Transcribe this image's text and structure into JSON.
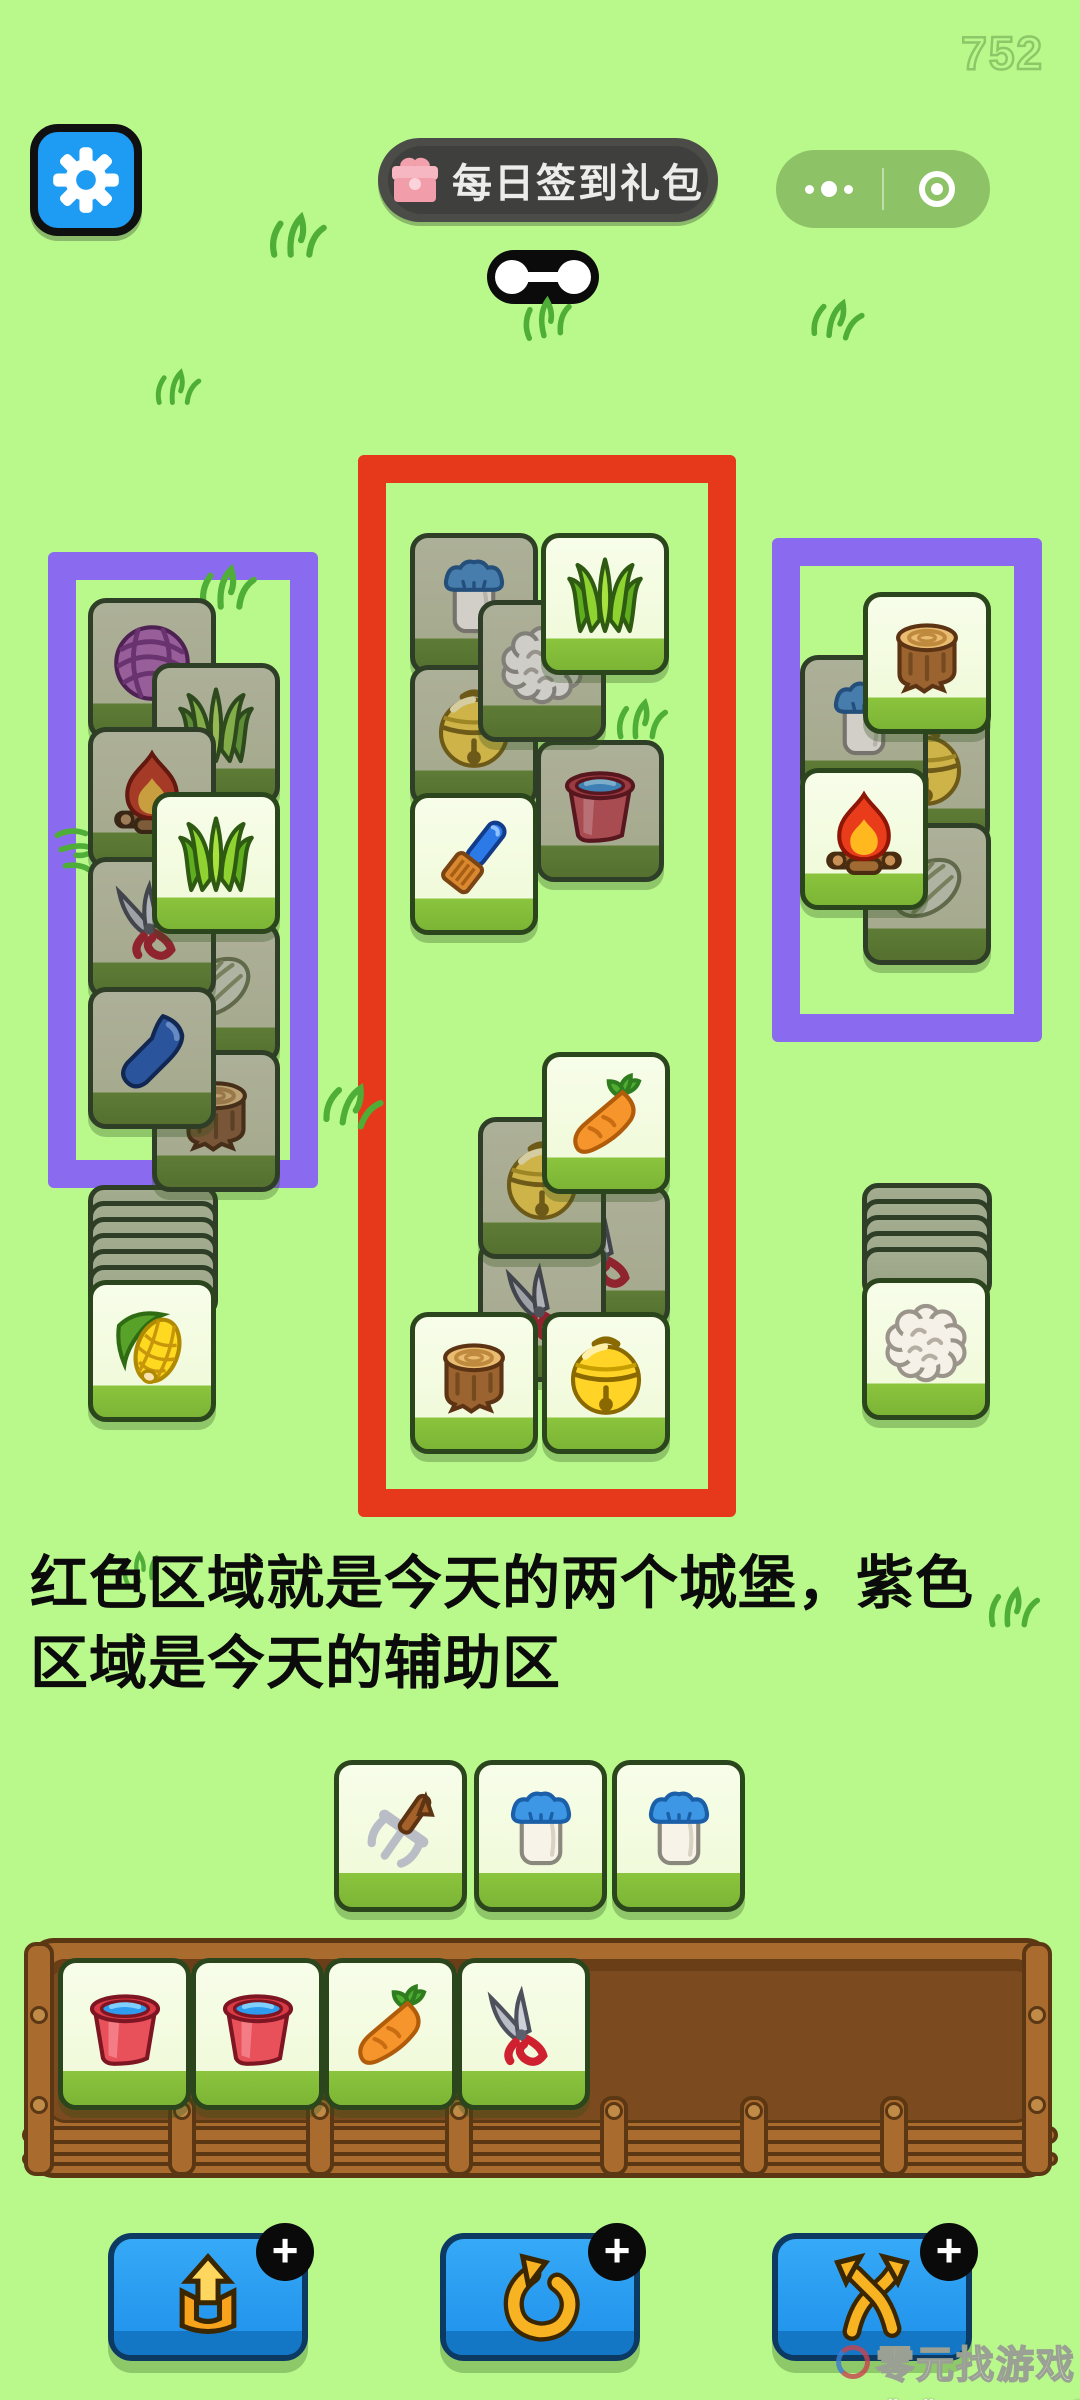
{
  "hud": {
    "counter": "752"
  },
  "gift_button": {
    "label": "每日签到礼包"
  },
  "capsule": {
    "icons": [
      "more-dots-icon",
      "target-circle-icon"
    ]
  },
  "caption": {
    "line1": "红色区域就是今天的两个城堡，紫色",
    "line2": "区域是今天的辅助区"
  },
  "colors": {
    "background": "#b9f98c",
    "red_zone": "#e6391c",
    "purple_zone": "#8a6bef",
    "tile_face_bright": "#f1fadb",
    "tile_face_dim": "#a6aa8e",
    "tray_wood": "#7b4a1e",
    "button_blue": "#1e90ea",
    "settings_blue": "#1e9bf2"
  },
  "board": {
    "groups": [
      {
        "name": "left-aux-purple",
        "tiles": [
          {
            "icon": "yarn",
            "state": "dim",
            "x": 88,
            "y": 598,
            "z": 1
          },
          {
            "icon": "grass",
            "state": "dim",
            "x": 152,
            "y": 663,
            "z": 2
          },
          {
            "icon": "fire",
            "state": "dim",
            "x": 88,
            "y": 727,
            "z": 3
          },
          {
            "icon": "lettuce",
            "state": "dim",
            "x": 152,
            "y": 922,
            "z": 4
          },
          {
            "icon": "shears",
            "state": "dim",
            "x": 88,
            "y": 857,
            "z": 5
          },
          {
            "icon": "stump",
            "state": "dim",
            "x": 152,
            "y": 1050,
            "z": 5
          },
          {
            "icon": "shovel",
            "state": "dim",
            "x": 88,
            "y": 987,
            "z": 6
          },
          {
            "icon": "grass",
            "state": "bright",
            "x": 152,
            "y": 792,
            "z": 7
          }
        ]
      },
      {
        "name": "castle-top-red",
        "tiles": [
          {
            "icon": "milk",
            "state": "dim",
            "x": 410,
            "y": 533,
            "z": 1
          },
          {
            "icon": "bell",
            "state": "dim",
            "x": 410,
            "y": 665,
            "z": 2
          },
          {
            "icon": "bucket",
            "state": "dim",
            "x": 536,
            "y": 740,
            "z": 2
          },
          {
            "icon": "wool",
            "state": "dim",
            "x": 478,
            "y": 600,
            "z": 3
          },
          {
            "icon": "brush",
            "state": "bright",
            "x": 410,
            "y": 793,
            "z": 4
          },
          {
            "icon": "grass",
            "state": "bright",
            "x": 541,
            "y": 533,
            "z": 5
          }
        ]
      },
      {
        "name": "castle-bottom-red",
        "tiles": [
          {
            "icon": "shears",
            "state": "dim",
            "x": 542,
            "y": 1185,
            "z": 1
          },
          {
            "icon": "shears",
            "state": "dim",
            "x": 478,
            "y": 1240,
            "z": 2
          },
          {
            "icon": "bell",
            "state": "dim",
            "x": 478,
            "y": 1117,
            "z": 3
          },
          {
            "icon": "stump",
            "state": "bright",
            "x": 410,
            "y": 1312,
            "z": 4
          },
          {
            "icon": "bell",
            "state": "bright",
            "x": 542,
            "y": 1312,
            "z": 4
          },
          {
            "icon": "carrot",
            "state": "bright",
            "x": 542,
            "y": 1052,
            "z": 5
          }
        ]
      },
      {
        "name": "right-aux-purple",
        "tiles": [
          {
            "icon": "bell",
            "state": "dim",
            "x": 862,
            "y": 703,
            "z": 1
          },
          {
            "icon": "milk",
            "state": "dim",
            "x": 800,
            "y": 655,
            "z": 2
          },
          {
            "icon": "lettuce",
            "state": "dim",
            "x": 863,
            "y": 823,
            "z": 2
          },
          {
            "icon": "fire",
            "state": "bright",
            "x": 800,
            "y": 768,
            "z": 3
          },
          {
            "icon": "stump",
            "state": "bright",
            "x": 863,
            "y": 592,
            "z": 4
          }
        ]
      }
    ]
  },
  "decks": {
    "left": {
      "backs": 6,
      "x": 88,
      "y": 1185,
      "card_y": 1280,
      "top_icon": "corn"
    },
    "right": {
      "backs": 5,
      "x": 862,
      "y": 1183,
      "card_y": 1278,
      "top_icon": "wool"
    }
  },
  "hand": {
    "y": 1760,
    "cards": [
      {
        "icon": "pitchfork",
        "x": 334
      },
      {
        "icon": "milk",
        "x": 474
      },
      {
        "icon": "milk",
        "x": 612
      }
    ]
  },
  "tray": {
    "capacity": 7,
    "slots": [
      "bucket",
      "bucket",
      "carrot",
      "shears"
    ]
  },
  "actions": {
    "badge": "+",
    "buttons": [
      {
        "name": "eject-tool-button",
        "icon": "eject"
      },
      {
        "name": "undo-tool-button",
        "icon": "undo"
      },
      {
        "name": "shuffle-tool-button",
        "icon": "shuffle"
      }
    ]
  },
  "decorations": {
    "doodles": [
      {
        "x": 266,
        "y": 208,
        "r": 0,
        "s": 1
      },
      {
        "x": 515,
        "y": 290,
        "r": -10,
        "s": 0.9
      },
      {
        "x": 806,
        "y": 292,
        "r": 8,
        "s": 0.9
      },
      {
        "x": 146,
        "y": 360,
        "r": 0,
        "s": 0.8
      },
      {
        "x": 196,
        "y": 560,
        "r": 0,
        "s": 1
      },
      {
        "x": 48,
        "y": 826,
        "r": 75,
        "s": 0.9
      },
      {
        "x": 610,
        "y": 692,
        "r": 0,
        "s": 0.9
      },
      {
        "x": 322,
        "y": 1078,
        "r": 12,
        "s": 1
      },
      {
        "x": 108,
        "y": 1540,
        "r": -15,
        "s": 0.7
      },
      {
        "x": 982,
        "y": 1580,
        "r": 0,
        "s": 0.9
      }
    ]
  },
  "sitemark": {
    "logo_text": "零元找游戏",
    "urls": "www.lingliuyx.com   www.06zyx.com"
  }
}
